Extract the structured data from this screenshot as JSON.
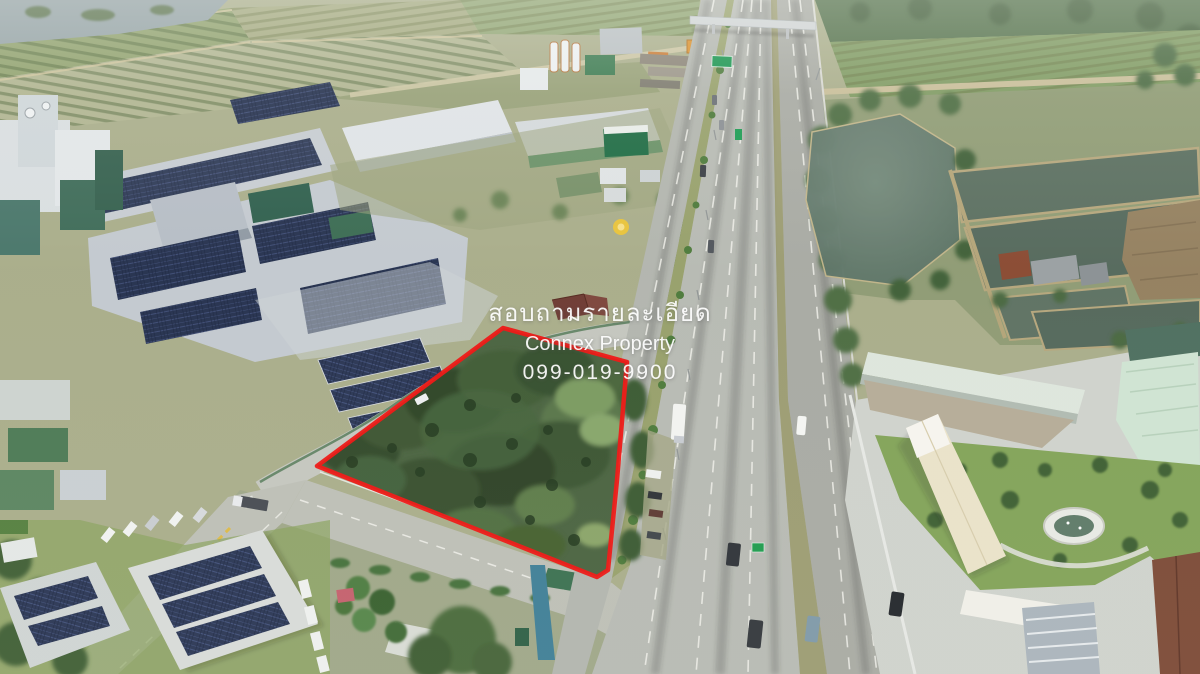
{
  "overlay": {
    "inquiry_line": "สอบถามรายละเอียด",
    "brand_line": "Connex Property",
    "phone_line": "099-019-9900"
  },
  "annotation": {
    "boundary_color": "#ee1512",
    "boundary_points": "317,466 503,328 627,362 617,480 608,570 597,577"
  },
  "palette": {
    "vegetation_dark": "#46613c",
    "highway_concrete": "#b7bab3",
    "pond_water": "#5d7467",
    "solar_panel": "#26324f"
  }
}
